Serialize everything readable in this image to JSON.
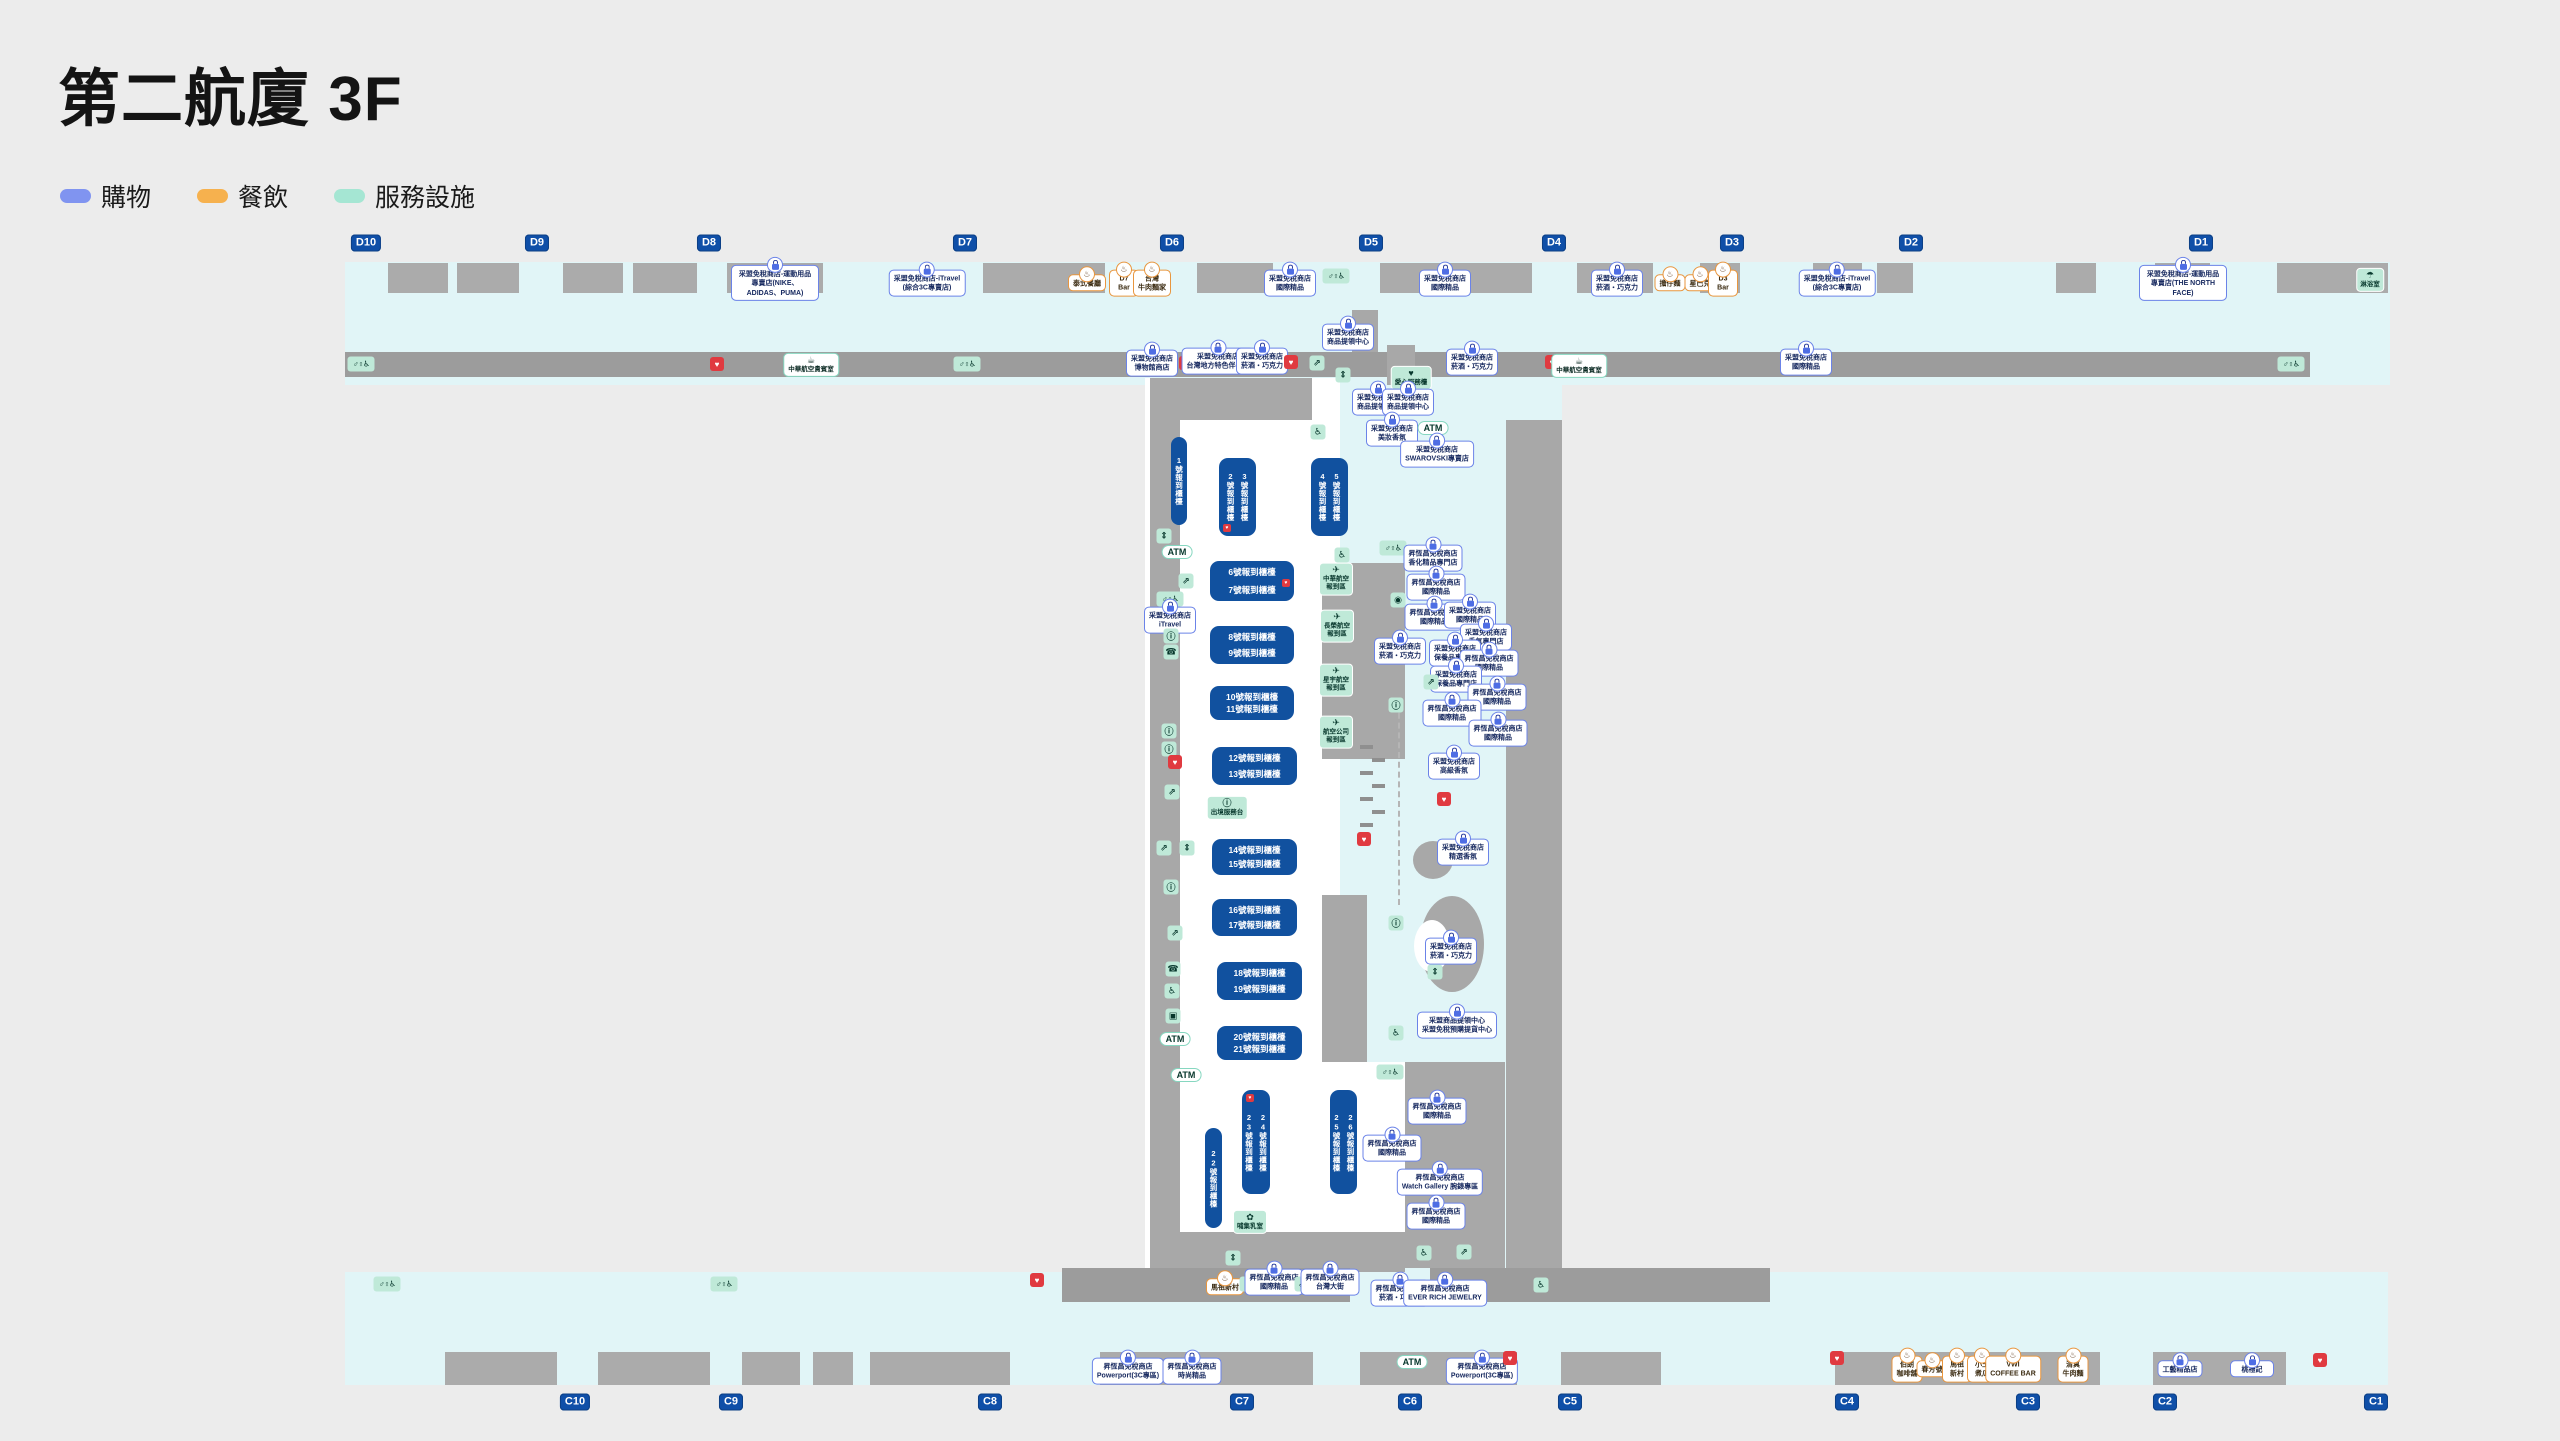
{
  "title": "第二航廈 3F",
  "legend": [
    {
      "label": "購物",
      "color": "#8094f0"
    },
    {
      "label": "餐飲",
      "color": "#f6b14e"
    },
    {
      "label": "服務設施",
      "color": "#a5e6d3"
    }
  ],
  "colors": {
    "gate_blue": "#0f4fa8",
    "counter_blue": "#11519f",
    "corridor_cyan": "#e1f5f7",
    "aed_red": "#e03a40"
  },
  "map": {
    "gates_top": {
      "y": 243,
      "items": [
        {
          "label": "D10",
          "x": 366
        },
        {
          "label": "D9",
          "x": 537
        },
        {
          "label": "D8",
          "x": 709
        },
        {
          "label": "D7",
          "x": 965
        },
        {
          "label": "D6",
          "x": 1172
        },
        {
          "label": "D5",
          "x": 1371
        },
        {
          "label": "D4",
          "x": 1554
        },
        {
          "label": "D3",
          "x": 1732
        },
        {
          "label": "D2",
          "x": 1911
        },
        {
          "label": "D1",
          "x": 2201
        }
      ]
    },
    "gates_bottom": {
      "y": 1402,
      "items": [
        {
          "label": "C10",
          "x": 575
        },
        {
          "label": "C9",
          "x": 731
        },
        {
          "label": "C8",
          "x": 990
        },
        {
          "label": "C7",
          "x": 1242
        },
        {
          "label": "C6",
          "x": 1410
        },
        {
          "label": "C5",
          "x": 1570
        },
        {
          "label": "C4",
          "x": 1847
        },
        {
          "label": "C3",
          "x": 2028
        },
        {
          "label": "C2",
          "x": 2165
        },
        {
          "label": "C1",
          "x": 2376
        }
      ]
    },
    "counters": [
      {
        "x": 1171,
        "y": 437,
        "w": 16,
        "h": 88,
        "dir": "v",
        "labels": [
          "1號報到櫃檯"
        ]
      },
      {
        "x": 1219,
        "y": 458,
        "w": 37,
        "h": 78,
        "dir": "v",
        "labels": [
          "2號報到櫃檯",
          "3號報到櫃檯"
        ],
        "aed": "b"
      },
      {
        "x": 1311,
        "y": 458,
        "w": 37,
        "h": 78,
        "dir": "v",
        "labels": [
          "4號報到櫃檯",
          "5號報到櫃檯"
        ]
      },
      {
        "x": 1210,
        "y": 561,
        "w": 84,
        "h": 40,
        "dir": "h",
        "labels": [
          "6號報到櫃檯",
          "7號報到櫃檯"
        ],
        "aed": "r"
      },
      {
        "x": 1210,
        "y": 626,
        "w": 84,
        "h": 38,
        "dir": "h",
        "labels": [
          "8號報到櫃檯",
          "9號報到櫃檯"
        ]
      },
      {
        "x": 1210,
        "y": 686,
        "w": 84,
        "h": 34,
        "dir": "h",
        "labels": [
          "10號報到櫃檯",
          "11號報到櫃檯"
        ]
      },
      {
        "x": 1212,
        "y": 747,
        "w": 85,
        "h": 38,
        "dir": "h",
        "labels": [
          "12號報到櫃檯",
          "13號報到櫃檯"
        ]
      },
      {
        "x": 1212,
        "y": 839,
        "w": 85,
        "h": 36,
        "dir": "h",
        "labels": [
          "14號報到櫃檯",
          "15號報到櫃檯"
        ]
      },
      {
        "x": 1212,
        "y": 899,
        "w": 85,
        "h": 37,
        "dir": "h",
        "labels": [
          "16號報到櫃檯",
          "17號報到櫃檯"
        ]
      },
      {
        "x": 1217,
        "y": 962,
        "w": 85,
        "h": 38,
        "dir": "h",
        "labels": [
          "18號報到櫃檯",
          "19號報到櫃檯"
        ]
      },
      {
        "x": 1217,
        "y": 1026,
        "w": 85,
        "h": 34,
        "dir": "h",
        "labels": [
          "20號報到櫃檯",
          "21號報到櫃檯"
        ]
      },
      {
        "x": 1205,
        "y": 1128,
        "w": 17,
        "h": 100,
        "dir": "v",
        "labels": [
          "22號報到櫃檯"
        ]
      },
      {
        "x": 1242,
        "y": 1090,
        "w": 28,
        "h": 104,
        "dir": "v",
        "labels": [
          "23號報到櫃檯",
          "24號報到櫃檯"
        ],
        "aed": "t"
      },
      {
        "x": 1330,
        "y": 1090,
        "w": 27,
        "h": 104,
        "dir": "v",
        "labels": [
          "25號報到櫃檯",
          "26號報到櫃檯"
        ]
      }
    ],
    "markers": [
      {
        "k": "sh",
        "x": 775,
        "y": 283,
        "t": "采盟免稅商店-運動用品\n專賣店(NIKE、ADIDAS、PUMA)"
      },
      {
        "k": "sh",
        "x": 927,
        "y": 283,
        "t": "采盟免稅商店-iTravel\n(綜合3C專賣店)"
      },
      {
        "k": "fd",
        "x": 1087,
        "y": 283,
        "t": "泰式餐廳"
      },
      {
        "k": "fd",
        "x": 1124,
        "y": 283,
        "t": "D7\nBar"
      },
      {
        "k": "fd",
        "x": 1152,
        "y": 283,
        "t": "台灣\n牛肉麵家"
      },
      {
        "k": "sh",
        "x": 1290,
        "y": 283,
        "t": "采盟免稅商店\n國際精品"
      },
      {
        "k": "wc",
        "x": 1336,
        "y": 276
      },
      {
        "k": "sh",
        "x": 1348,
        "y": 337,
        "t": "采盟免稅商店\n商品提領中心"
      },
      {
        "k": "sh",
        "x": 1445,
        "y": 283,
        "t": "采盟免稅商店\n國際精品"
      },
      {
        "k": "sh",
        "x": 1617,
        "y": 283,
        "t": "采盟免稅商店\n菸酒・巧克力"
      },
      {
        "k": "fd",
        "x": 1670,
        "y": 283,
        "t": "擔仔麵"
      },
      {
        "k": "fd",
        "x": 1700,
        "y": 283,
        "t": "星巴克"
      },
      {
        "k": "fd",
        "x": 1723,
        "y": 283,
        "t": "D3\nBar"
      },
      {
        "k": "sh",
        "x": 1837,
        "y": 283,
        "t": "采盟免稅商店-iTravel\n(綜合3C專賣店)"
      },
      {
        "k": "sh",
        "x": 2183,
        "y": 283,
        "t": "采盟免稅商店-運動用品\n專賣店(THE NORTH FACE)"
      },
      {
        "k": "svc",
        "x": 2370,
        "y": 280,
        "g": "☂",
        "t": "淋浴室"
      },
      {
        "k": "wc",
        "x": 361,
        "y": 364
      },
      {
        "k": "aed",
        "x": 717,
        "y": 364
      },
      {
        "k": "svw",
        "x": 811,
        "y": 365,
        "g": "☕",
        "t": "中華航空貴賓室"
      },
      {
        "k": "wc",
        "x": 967,
        "y": 364
      },
      {
        "k": "sh",
        "x": 1472,
        "y": 362,
        "t": "采盟免稅商店\n菸酒・巧克力"
      },
      {
        "k": "aed",
        "x": 1552,
        "y": 362
      },
      {
        "k": "svw",
        "x": 1579,
        "y": 366,
        "g": "☕",
        "t": "中華航空貴賓室"
      },
      {
        "k": "sh",
        "x": 1806,
        "y": 362,
        "t": "采盟免稅商店\n國際精品"
      },
      {
        "k": "wc",
        "x": 2291,
        "y": 364
      },
      {
        "k": "sh",
        "x": 1152,
        "y": 363,
        "t": "采盟免稅商店\n博物館商店"
      },
      {
        "k": "aed",
        "x": 1186,
        "y": 363
      },
      {
        "k": "sh",
        "x": 1218,
        "y": 361,
        "t": "采盟免稅商店\n台灣地方特色伴手禮"
      },
      {
        "k": "sh",
        "x": 1262,
        "y": 361,
        "t": "采盟免稅商店\n菸酒・巧克力"
      },
      {
        "k": "aed",
        "x": 1291,
        "y": 362
      },
      {
        "k": "es",
        "x": 1317,
        "y": 363
      },
      {
        "k": "el",
        "x": 1343,
        "y": 375
      },
      {
        "k": "svc",
        "x": 1411,
        "y": 378,
        "g": "♥",
        "t": "愛心服務檯"
      },
      {
        "k": "sh",
        "x": 1378,
        "y": 402,
        "t": "采盟免稅商店\n商品提領中心"
      },
      {
        "k": "sh",
        "x": 1408,
        "y": 402,
        "t": "采盟免稅商店\n商品提領中心"
      },
      {
        "k": "sh",
        "x": 1392,
        "y": 433,
        "t": "采盟免稅商店\n美妝香氛"
      },
      {
        "k": "atm",
        "x": 1433,
        "y": 428
      },
      {
        "k": "wh",
        "x": 1318,
        "y": 432
      },
      {
        "k": "sh",
        "x": 1437,
        "y": 454,
        "t": "采盟免稅商店\nSWAROVSKI專賣店"
      },
      {
        "k": "el",
        "x": 1164,
        "y": 536
      },
      {
        "k": "atm",
        "x": 1177,
        "y": 552
      },
      {
        "k": "es",
        "x": 1186,
        "y": 581
      },
      {
        "k": "wc",
        "x": 1170,
        "y": 599
      },
      {
        "k": "sh",
        "x": 1170,
        "y": 620,
        "t": "采盟免稅商店\niTravel"
      },
      {
        "k": "in",
        "x": 1171,
        "y": 636
      },
      {
        "k": "ph",
        "x": 1171,
        "y": 652
      },
      {
        "k": "in",
        "x": 1169,
        "y": 731
      },
      {
        "k": "in",
        "x": 1169,
        "y": 749
      },
      {
        "k": "aed",
        "x": 1175,
        "y": 762
      },
      {
        "k": "es",
        "x": 1172,
        "y": 792
      },
      {
        "k": "es",
        "x": 1164,
        "y": 848
      },
      {
        "k": "el",
        "x": 1187,
        "y": 848
      },
      {
        "k": "svc",
        "x": 1227,
        "y": 808,
        "g": "ⓘ",
        "t": "出境服務台"
      },
      {
        "k": "in",
        "x": 1171,
        "y": 887
      },
      {
        "k": "es",
        "x": 1175,
        "y": 933
      },
      {
        "k": "ph",
        "x": 1173,
        "y": 969
      },
      {
        "k": "wh",
        "x": 1172,
        "y": 991
      },
      {
        "k": "lu",
        "x": 1173,
        "y": 1016
      },
      {
        "k": "atm",
        "x": 1175,
        "y": 1039
      },
      {
        "k": "atm",
        "x": 1186,
        "y": 1075
      },
      {
        "k": "wh",
        "x": 1342,
        "y": 555
      },
      {
        "k": "wc",
        "x": 1393,
        "y": 548
      },
      {
        "k": "svc",
        "x": 1336,
        "y": 579,
        "g": "✈",
        "t": "中華航空\n報到區"
      },
      {
        "k": "wa",
        "x": 1398,
        "y": 600
      },
      {
        "k": "svc",
        "x": 1337,
        "y": 626,
        "g": "✈",
        "t": "長榮航空\n報到區"
      },
      {
        "k": "sh",
        "x": 1400,
        "y": 651,
        "t": "采盟免稅商店\n菸酒・巧克力"
      },
      {
        "k": "svc",
        "x": 1336,
        "y": 680,
        "g": "✈",
        "t": "星宇航空\n報到區"
      },
      {
        "k": "in",
        "x": 1396,
        "y": 705
      },
      {
        "k": "svc",
        "x": 1336,
        "y": 732,
        "g": "✈",
        "t": "航空公司\n報到區"
      },
      {
        "k": "aed",
        "x": 1364,
        "y": 839
      },
      {
        "k": "aed",
        "x": 1444,
        "y": 799
      },
      {
        "k": "sh",
        "x": 1463,
        "y": 852,
        "t": "采盟免稅商店\n精選香氛"
      },
      {
        "k": "in",
        "x": 1396,
        "y": 923
      },
      {
        "k": "sh",
        "x": 1451,
        "y": 951,
        "t": "采盟免稅商店\n菸酒・巧克力"
      },
      {
        "k": "el",
        "x": 1435,
        "y": 972
      },
      {
        "k": "sh",
        "x": 1457,
        "y": 1025,
        "t": "采盟商品提領中心\n采盟免稅預購提貨中心"
      },
      {
        "k": "wh",
        "x": 1396,
        "y": 1033
      },
      {
        "k": "sh",
        "x": 1433,
        "y": 558,
        "t": "昇恆昌免稅商店\n香化精品專門店"
      },
      {
        "k": "sh",
        "x": 1436,
        "y": 587,
        "t": "昇恆昌免稅商店\n國際精品"
      },
      {
        "k": "sh",
        "x": 1434,
        "y": 617,
        "t": "昇恆昌免稅商店\n國際精品"
      },
      {
        "k": "sh",
        "x": 1470,
        "y": 615,
        "t": "采盟免稅商店\n國際精品"
      },
      {
        "k": "sh",
        "x": 1486,
        "y": 637,
        "t": "采盟免稅商店\n香氛專門店"
      },
      {
        "k": "sh",
        "x": 1455,
        "y": 653,
        "t": "采盟免稅商店\n保養品專門店"
      },
      {
        "k": "sh",
        "x": 1489,
        "y": 663,
        "t": "昇恆昌免稅商店\n國際精品"
      },
      {
        "k": "sh",
        "x": 1456,
        "y": 679,
        "t": "采盟免稅商店\n保養品專門店"
      },
      {
        "k": "es",
        "x": 1431,
        "y": 682
      },
      {
        "k": "sh",
        "x": 1497,
        "y": 697,
        "t": "昇恆昌免稅商店\n國際精品"
      },
      {
        "k": "sh",
        "x": 1452,
        "y": 713,
        "t": "昇恆昌免稅商店\n國際精品"
      },
      {
        "k": "sh",
        "x": 1498,
        "y": 733,
        "t": "昇恆昌免稅商店\n國際精品"
      },
      {
        "k": "sh",
        "x": 1454,
        "y": 766,
        "t": "采盟免稅商店\n高級香氛"
      },
      {
        "k": "wc",
        "x": 1390,
        "y": 1072
      },
      {
        "k": "sh",
        "x": 1437,
        "y": 1111,
        "t": "昇恆昌免稅商店\n國際精品"
      },
      {
        "k": "sh",
        "x": 1392,
        "y": 1148,
        "t": "昇恆昌免稅商店\n國際精品"
      },
      {
        "k": "sh",
        "x": 1440,
        "y": 1182,
        "t": "昇恆昌免稅商店\nWatch Gallery 腕錶專區"
      },
      {
        "k": "sh",
        "x": 1436,
        "y": 1216,
        "t": "昇恆昌免稅商店\n國際精品"
      },
      {
        "k": "wh",
        "x": 1424,
        "y": 1253
      },
      {
        "k": "es",
        "x": 1464,
        "y": 1252
      },
      {
        "k": "svc",
        "x": 1250,
        "y": 1222,
        "g": "✿",
        "t": "哺集乳室"
      },
      {
        "k": "el",
        "x": 1233,
        "y": 1258
      },
      {
        "k": "fd",
        "x": 1225,
        "y": 1287,
        "t": "馬祖新村"
      },
      {
        "k": "el",
        "x": 1247,
        "y": 1284
      },
      {
        "k": "sh",
        "x": 1274,
        "y": 1282,
        "t": "昇恆昌免稅商店\n國際精品"
      },
      {
        "k": "es",
        "x": 1302,
        "y": 1284
      },
      {
        "k": "sh",
        "x": 1330,
        "y": 1282,
        "t": "昇恆昌免稅商店\n台灣大街"
      },
      {
        "k": "sh",
        "x": 1400,
        "y": 1293,
        "t": "昇恆昌免稅商店\n菸酒・巧克力"
      },
      {
        "k": "sh",
        "x": 1445,
        "y": 1293,
        "t": "昇恆昌免稅商店\nEVER RICH JEWELRY"
      },
      {
        "k": "wh",
        "x": 1541,
        "y": 1285
      },
      {
        "k": "wc",
        "x": 387,
        "y": 1284
      },
      {
        "k": "wc",
        "x": 724,
        "y": 1284
      },
      {
        "k": "aed",
        "x": 1037,
        "y": 1280
      },
      {
        "k": "sh",
        "x": 1128,
        "y": 1371,
        "t": "昇恆昌免稅商店\nPowerport(3C專區)"
      },
      {
        "k": "sh",
        "x": 1192,
        "y": 1371,
        "t": "昇恆昌免稅商店\n時尚精品"
      },
      {
        "k": "atm",
        "x": 1412,
        "y": 1362
      },
      {
        "k": "sh",
        "x": 1482,
        "y": 1371,
        "t": "昇恆昌免稅商店\nPowerport(3C專區)"
      },
      {
        "k": "aed",
        "x": 1510,
        "y": 1358
      },
      {
        "k": "aed",
        "x": 1837,
        "y": 1358
      },
      {
        "k": "fd",
        "x": 1907,
        "y": 1369,
        "t": "伯朗\n咖啡舖"
      },
      {
        "k": "fd",
        "x": 1932,
        "y": 1369,
        "t": "春芳號"
      },
      {
        "k": "fd",
        "x": 1957,
        "y": 1369,
        "t": "馬祖\n新村"
      },
      {
        "k": "fd",
        "x": 1982,
        "y": 1369,
        "t": "小王\n煮瓜"
      },
      {
        "k": "fd",
        "x": 2013,
        "y": 1369,
        "t": "VWI\nCOFFEE BAR"
      },
      {
        "k": "fd",
        "x": 2073,
        "y": 1369,
        "t": "清真\n牛肉麵"
      },
      {
        "k": "sh",
        "x": 2180,
        "y": 1369,
        "t": "工藝精品店"
      },
      {
        "k": "sh",
        "x": 2252,
        "y": 1369,
        "t": "桃禮記"
      },
      {
        "k": "aed",
        "x": 2320,
        "y": 1360
      }
    ]
  }
}
